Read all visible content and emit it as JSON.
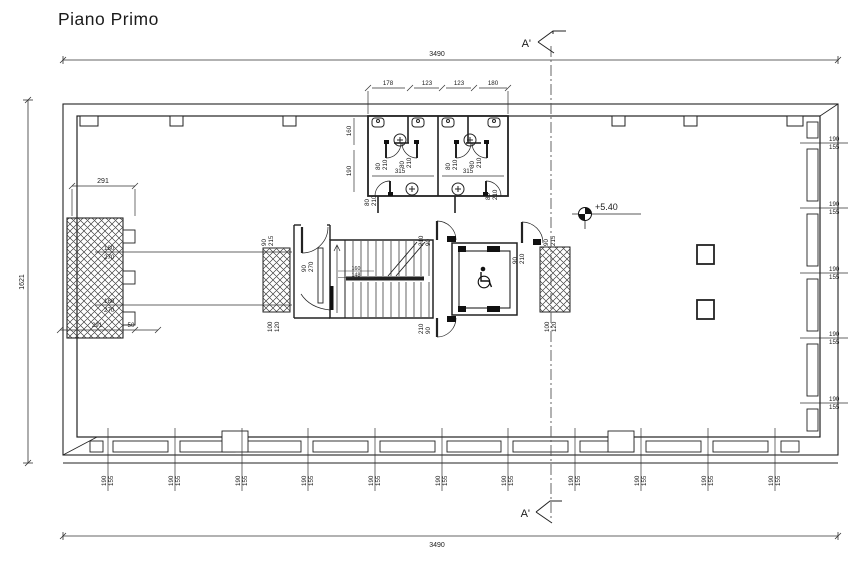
{
  "title": "Piano Primo",
  "section": {
    "top": "A'",
    "bottom": "A'"
  },
  "overall_dims": {
    "top": "3490",
    "bottom": "3490",
    "left": "1621"
  },
  "elevation": {
    "value": "+5.40"
  },
  "left_block": {
    "top_dim": "291",
    "opening_1": {
      "w": "180",
      "h": "270"
    },
    "opening_2": {
      "w": "180",
      "h": "270"
    },
    "bottom_dim_a": "291",
    "bottom_dim_b": "50"
  },
  "bathroom": {
    "top_dims": [
      "178",
      "123",
      "123",
      "180"
    ],
    "side_dims": [
      "160",
      "190"
    ],
    "widths": [
      "315",
      "315"
    ],
    "doors": [
      {
        "w": "80",
        "h": "210"
      },
      {
        "w": "80",
        "h": "210"
      },
      {
        "w": "80",
        "h": "210"
      },
      {
        "w": "80",
        "h": "210"
      },
      {
        "w": "80",
        "h": "210"
      },
      {
        "w": "80",
        "h": "210"
      }
    ]
  },
  "core": {
    "door_left_top": {
      "w": "90",
      "h": "215"
    },
    "door_lobby": {
      "w": "90",
      "h": "270"
    },
    "shaft_left_dim": {
      "w": "100",
      "h": "120"
    },
    "stair_dims": [
      "160",
      "148"
    ],
    "door_elevator_top": {
      "w": "90",
      "h": "210"
    },
    "door_elevator_bottom": {
      "w": "90",
      "h": "210"
    },
    "door_right": {
      "w": "90",
      "h": "210"
    },
    "door_right_top": {
      "w": "90",
      "h": "215"
    },
    "shaft_right_dim": {
      "w": "100",
      "h": "120"
    }
  },
  "right_windows": [
    {
      "w": "190",
      "h": "155"
    },
    {
      "w": "190",
      "h": "155"
    },
    {
      "w": "190",
      "h": "155"
    },
    {
      "w": "190",
      "h": "155"
    },
    {
      "w": "190",
      "h": "155"
    }
  ],
  "bottom_windows": [
    {
      "w": "190",
      "h": "155"
    },
    {
      "w": "190",
      "h": "155"
    },
    {
      "w": "190",
      "h": "155"
    },
    {
      "w": "190",
      "h": "155"
    },
    {
      "w": "190",
      "h": "155"
    },
    {
      "w": "190",
      "h": "155"
    },
    {
      "w": "190",
      "h": "155"
    },
    {
      "w": "190",
      "h": "155"
    },
    {
      "w": "190",
      "h": "155"
    },
    {
      "w": "190",
      "h": "155"
    },
    {
      "w": "190",
      "h": "155"
    }
  ]
}
